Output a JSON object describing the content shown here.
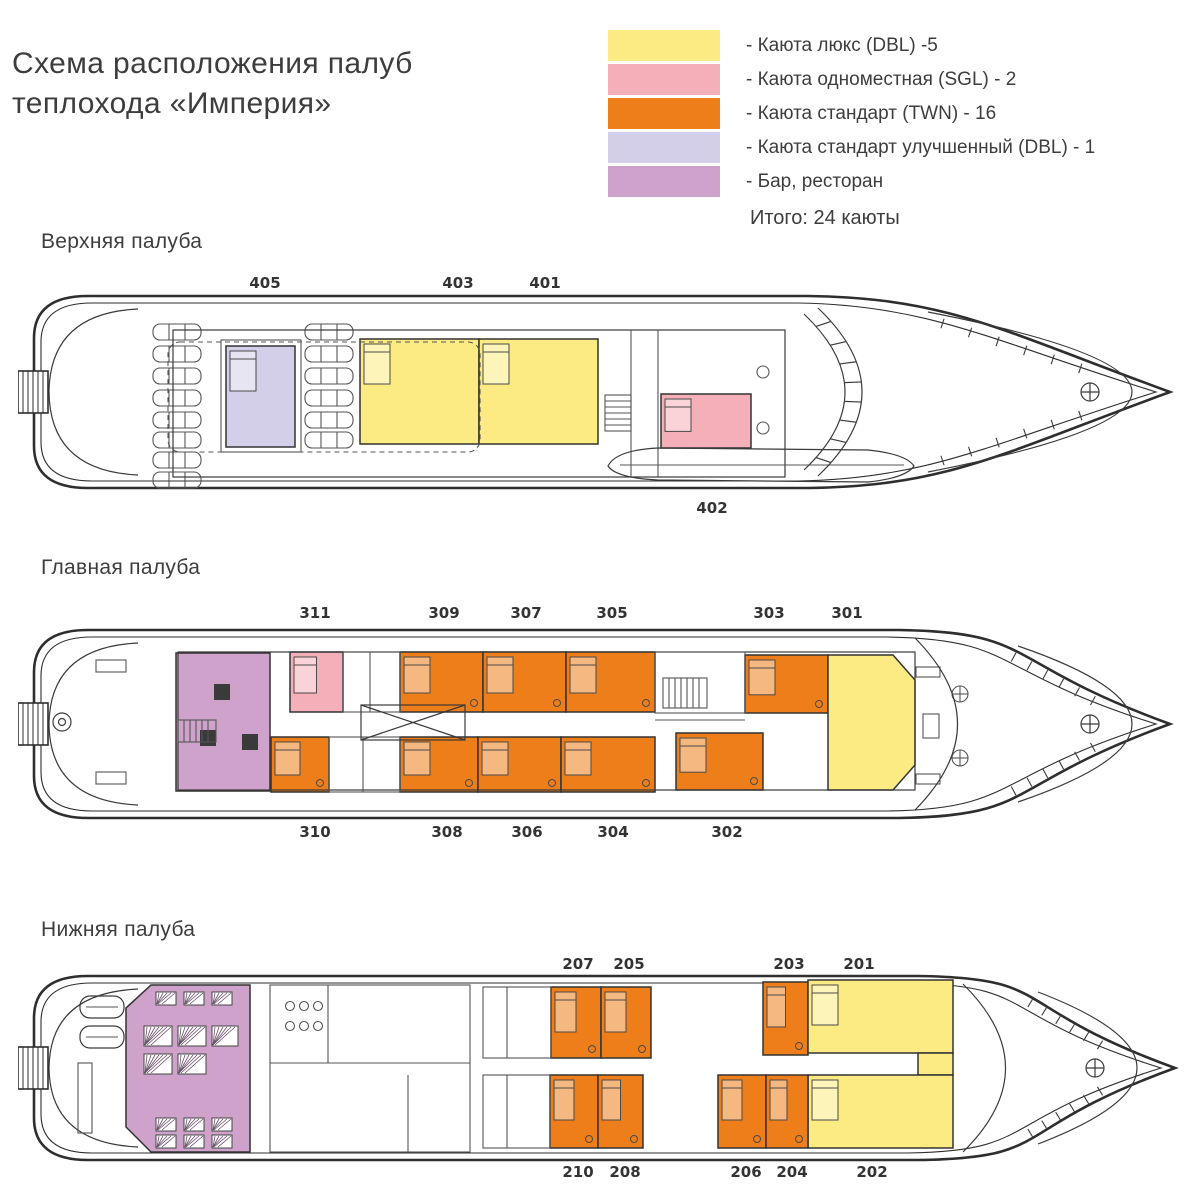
{
  "title": {
    "line1": "Схема расположения палуб",
    "line2": "теплохода «Империя»"
  },
  "legend": {
    "items": [
      {
        "key": "lux",
        "color": "#FBEB82",
        "label": "- Каюта люкс (DBL) -5"
      },
      {
        "key": "sgl",
        "color": "#F4AFB8",
        "label": "- Каюта одноместная (SGL) - 2"
      },
      {
        "key": "twn",
        "color": "#EE7E1A",
        "label": "- Каюта стандарт (TWN) - 16"
      },
      {
        "key": "dbl_imp",
        "color": "#D3CFE8",
        "label": "- Каюта стандарт улучшенный (DBL) - 1"
      },
      {
        "key": "bar",
        "color": "#CEA2CA",
        "label": "- Бар, ресторан"
      }
    ],
    "total": "Итого: 24 каюты"
  },
  "decks": [
    {
      "id": "upper",
      "name": "Верхняя палуба",
      "name_pos": {
        "x": 41,
        "y": 230
      },
      "plan_pos": {
        "x": 18,
        "y": 290,
        "w": 1162,
        "h": 205
      },
      "hull": {
        "top": 6,
        "bottom": 198,
        "taper": 790,
        "tip": 1152
      },
      "rooms": [
        {
          "number": "405",
          "type": "dbl_imp",
          "shape": "rect",
          "x": 208,
          "y": 56,
          "w": 69,
          "h": 101
        },
        {
          "number": "403",
          "type": "lux",
          "shape": "rect",
          "x": 342,
          "y": 49,
          "w": 119,
          "h": 105
        },
        {
          "number": "401",
          "type": "lux",
          "shape": "rect",
          "x": 461,
          "y": 49,
          "w": 119,
          "h": 105
        },
        {
          "number": "402",
          "type": "sgl",
          "shape": "rect",
          "x": 643,
          "y": 104,
          "w": 90,
          "h": 54
        }
      ],
      "labels": [
        {
          "text": "405",
          "x": 265,
          "y": 283
        },
        {
          "text": "403",
          "x": 458,
          "y": 283
        },
        {
          "text": "401",
          "x": 545,
          "y": 283
        },
        {
          "text": "402",
          "x": 712,
          "y": 508
        }
      ]
    },
    {
      "id": "main",
      "name": "Главная палуба",
      "name_pos": {
        "x": 41,
        "y": 556
      },
      "plan_pos": {
        "x": 18,
        "y": 622,
        "w": 1162,
        "h": 200
      },
      "hull": {
        "top": 8,
        "bottom": 196,
        "taper": 880,
        "tip": 1152
      },
      "rooms": [
        {
          "type": "bar",
          "shape": "rect",
          "x": 158,
          "y": 31,
          "w": 94,
          "h": 138,
          "name": "bar-restaurant"
        },
        {
          "number": "311",
          "type": "sgl",
          "shape": "rect",
          "x": 272,
          "y": 30,
          "w": 53,
          "h": 60
        },
        {
          "number": "309",
          "type": "twn",
          "shape": "rect",
          "x": 382,
          "y": 30,
          "w": 83,
          "h": 60
        },
        {
          "number": "307",
          "type": "twn",
          "shape": "rect",
          "x": 465,
          "y": 30,
          "w": 83,
          "h": 60
        },
        {
          "number": "305",
          "type": "twn",
          "shape": "rect",
          "x": 548,
          "y": 30,
          "w": 89,
          "h": 60
        },
        {
          "number": "303",
          "type": "twn",
          "shape": "rect",
          "x": 727,
          "y": 33,
          "w": 83,
          "h": 58
        },
        {
          "number": "301",
          "type": "lux",
          "shape": "poly",
          "points": "810,33 875,33 897,58 897,143 875,168 810,168"
        },
        {
          "number": "310",
          "type": "twn",
          "shape": "rect",
          "x": 253,
          "y": 115,
          "w": 58,
          "h": 55
        },
        {
          "number": "308",
          "type": "twn",
          "shape": "rect",
          "x": 382,
          "y": 115,
          "w": 78,
          "h": 55
        },
        {
          "number": "306",
          "type": "twn",
          "shape": "rect",
          "x": 460,
          "y": 115,
          "w": 83,
          "h": 55
        },
        {
          "number": "304",
          "type": "twn",
          "shape": "rect",
          "x": 543,
          "y": 115,
          "w": 94,
          "h": 55
        },
        {
          "number": "302",
          "type": "twn",
          "shape": "rect",
          "x": 658,
          "y": 111,
          "w": 87,
          "h": 57
        }
      ],
      "labels": [
        {
          "text": "311",
          "x": 315,
          "y": 613
        },
        {
          "text": "309",
          "x": 444,
          "y": 613
        },
        {
          "text": "307",
          "x": 526,
          "y": 613
        },
        {
          "text": "305",
          "x": 612,
          "y": 613
        },
        {
          "text": "303",
          "x": 769,
          "y": 613
        },
        {
          "text": "301",
          "x": 847,
          "y": 613
        },
        {
          "text": "310",
          "x": 315,
          "y": 832
        },
        {
          "text": "308",
          "x": 447,
          "y": 832
        },
        {
          "text": "306",
          "x": 527,
          "y": 832
        },
        {
          "text": "304",
          "x": 613,
          "y": 832
        },
        {
          "text": "302",
          "x": 727,
          "y": 832
        }
      ]
    },
    {
      "id": "lower",
      "name": "Нижняя палуба",
      "name_pos": {
        "x": 41,
        "y": 918
      },
      "plan_pos": {
        "x": 18,
        "y": 968,
        "w": 1162,
        "h": 200
      },
      "hull": {
        "top": 8,
        "bottom": 192,
        "taper": 900,
        "tip": 1157
      },
      "rooms": [
        {
          "type": "bar",
          "shape": "poly",
          "points": "133,17 232,17 232,184 133,184 108,159 108,40",
          "name": "restaurant"
        },
        {
          "number": "207",
          "type": "twn",
          "shape": "rect",
          "x": 533,
          "y": 19,
          "w": 50,
          "h": 71
        },
        {
          "number": "205",
          "type": "twn",
          "shape": "rect",
          "x": 583,
          "y": 19,
          "w": 50,
          "h": 71
        },
        {
          "number": "203",
          "type": "twn",
          "shape": "rect",
          "x": 745,
          "y": 14,
          "w": 45,
          "h": 73
        },
        {
          "number": "201",
          "type": "lux",
          "shape": "rect",
          "x": 790,
          "y": 12,
          "w": 145,
          "h": 73
        },
        {
          "type": "lux",
          "shape": "rect",
          "x": 900,
          "y": 85,
          "w": 35,
          "h": 22,
          "name": "suite-connector"
        },
        {
          "number": "202",
          "type": "lux",
          "shape": "rect",
          "x": 790,
          "y": 107,
          "w": 145,
          "h": 73
        },
        {
          "number": "210",
          "type": "twn",
          "shape": "rect",
          "x": 532,
          "y": 107,
          "w": 48,
          "h": 73
        },
        {
          "number": "208",
          "type": "twn",
          "shape": "rect",
          "x": 580,
          "y": 107,
          "w": 45,
          "h": 73
        },
        {
          "number": "206",
          "type": "twn",
          "shape": "rect",
          "x": 700,
          "y": 107,
          "w": 48,
          "h": 73
        },
        {
          "number": "204",
          "type": "twn",
          "shape": "rect",
          "x": 748,
          "y": 107,
          "w": 42,
          "h": 73
        }
      ],
      "labels": [
        {
          "text": "207",
          "x": 578,
          "y": 964
        },
        {
          "text": "205",
          "x": 629,
          "y": 964
        },
        {
          "text": "203",
          "x": 789,
          "y": 964
        },
        {
          "text": "201",
          "x": 859,
          "y": 964
        },
        {
          "text": "210",
          "x": 578,
          "y": 1172
        },
        {
          "text": "208",
          "x": 625,
          "y": 1172
        },
        {
          "text": "206",
          "x": 746,
          "y": 1172
        },
        {
          "text": "204",
          "x": 792,
          "y": 1172
        },
        {
          "text": "202",
          "x": 872,
          "y": 1172
        }
      ]
    }
  ]
}
